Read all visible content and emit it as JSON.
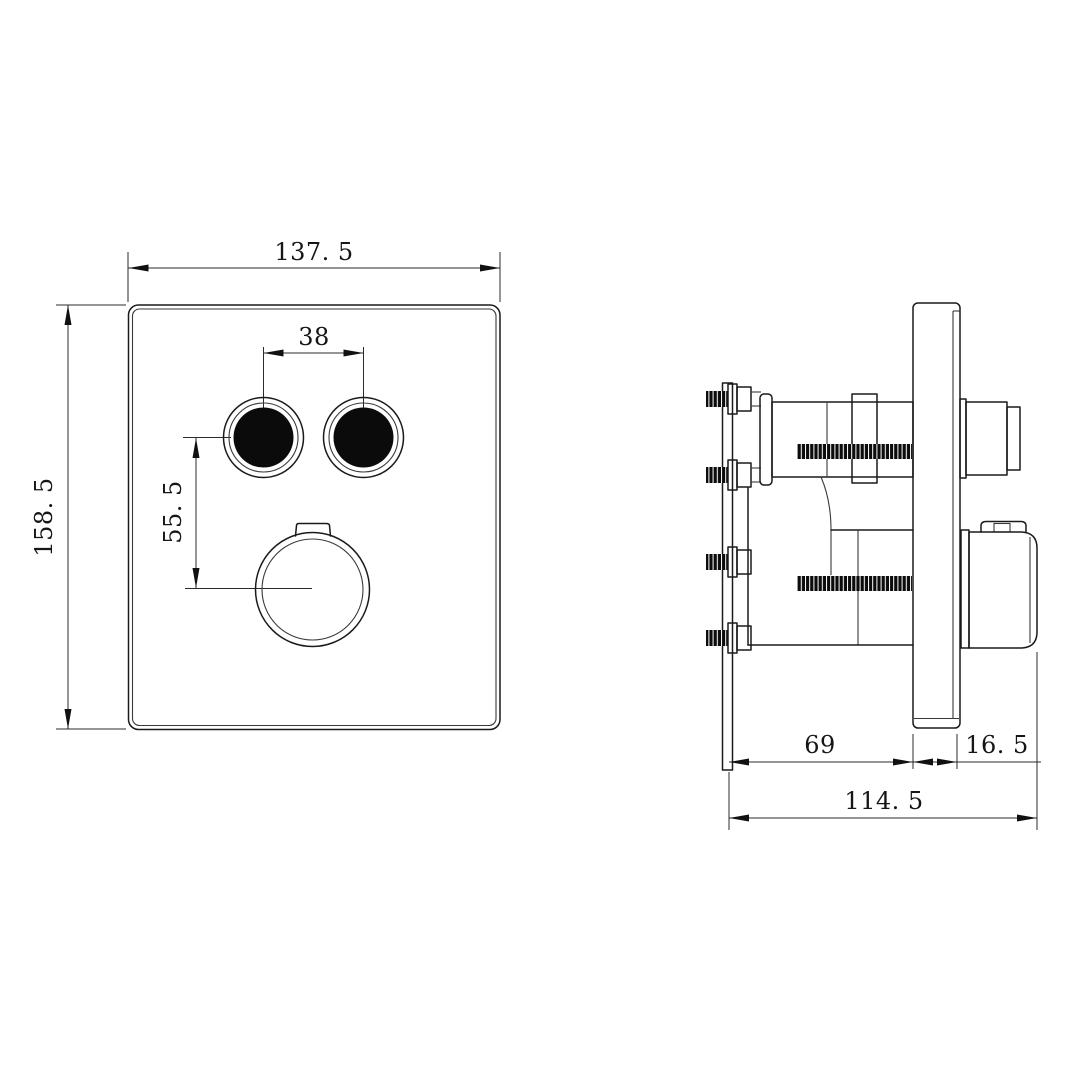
{
  "colors": {
    "line": "#1a1a1a",
    "background": "#ffffff",
    "dark_fill": "#0b0b0b"
  },
  "front_view": {
    "dims": {
      "plate_width": "137. 5",
      "plate_height": "158. 5",
      "button_spacing": "38",
      "button_to_knob": "55. 5"
    }
  },
  "side_view": {
    "dims": {
      "mounting_depth": "69",
      "plate_knob_depth": "16. 5",
      "overall_depth": "114. 5"
    }
  }
}
